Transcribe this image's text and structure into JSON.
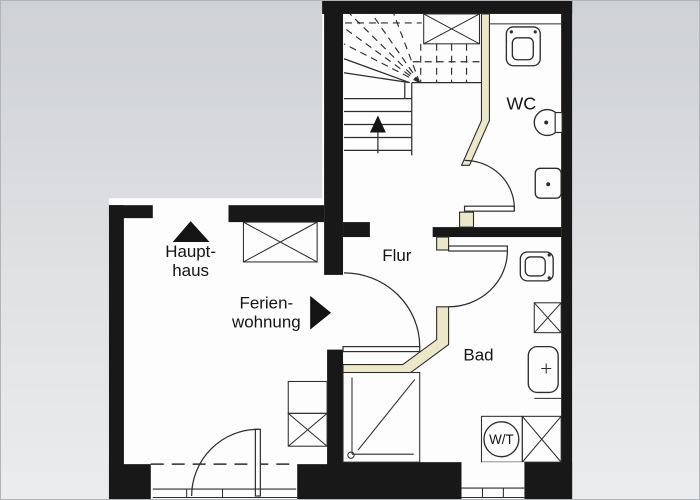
{
  "palette": {
    "bg-top": "#ced1d5",
    "bg-bottom": "#ebeced",
    "wall": "#181818",
    "floor": "#fdfdfd",
    "line": "#2d2d2d",
    "part-fill": "#ece7c9",
    "part-stroke": "#2b2b2b",
    "text": "#141414"
  },
  "rooms": {
    "flur": {
      "label": "Flur"
    },
    "wc": {
      "label": "WC"
    },
    "bad": {
      "label": "Bad"
    }
  },
  "directions": {
    "haupthaus": {
      "line1": "Haupt-",
      "line2": "haus",
      "arrow": "up-triangle"
    },
    "ferienwohnung": {
      "line1": "Ferien-",
      "line2": "wohnung",
      "arrow": "right-triangle"
    }
  },
  "appliances": {
    "washer_dryer": {
      "label": "W/T"
    }
  },
  "icons": {
    "stairs_up_arrow": "up-arrow",
    "haupthaus_arrow": "filled-up-triangle",
    "ferienwohnung_arrow": "filled-right-triangle",
    "shaft_boxes": "crossed-rectangle",
    "shower": "square-with-diagonal-and-drain",
    "toilet": "rounded-rect-bowl",
    "washbasin_round": "circle-basin",
    "washbasin": "rounded-rect-basin",
    "washer_dryer": "circle-in-square"
  }
}
